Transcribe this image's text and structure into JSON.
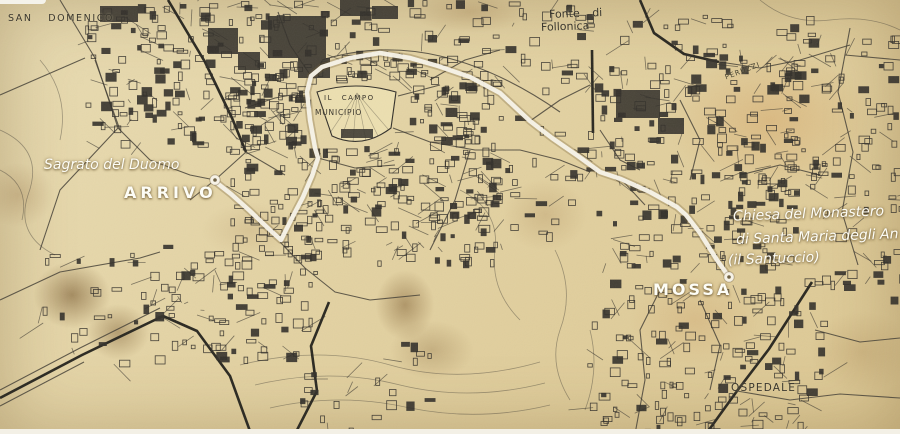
{
  "map": {
    "region_labels": {
      "san_domenico": "SAN DOMENICO",
      "fonte_line1": "Fonte di",
      "fonte_line2": "Follonica",
      "peruzzi": "PERUZZI",
      "il_campo": "IL CAMPO",
      "municipio": "MUNICIPIO",
      "ospedale": "OSPEDALE"
    },
    "route_labels": {
      "sagrato_del_duomo": "Sagrato del Duomo",
      "arrivo": "ARRIVO",
      "chiesa_line1": "Chiesa del Monastero",
      "chiesa_line2": "di Santa Maria degli An",
      "chiesa_line3": "(il Santuccio)",
      "mossa": "MOSSA"
    },
    "route": {
      "points": "217,183 231,194 250,211 271,231 281,240 292,218 303,197 312,176 318,158 315,148 310,120 307,92 311,76 322,67 350,58 380,53 410,58 438,66 470,77 500,93 530,121 552,138 578,156 600,172 621,179 650,192 677,207 686,215 700,233 717,260 729,277",
      "start": {
        "x": "729",
        "y": "277",
        "label": "MOSSA"
      },
      "end": {
        "x": "215",
        "y": "180",
        "label": "ARRIVO"
      }
    },
    "colors": {
      "paper": "#e4d4a6",
      "ink": "#33302a",
      "stain": "#8d6c42",
      "route_line": "#f8f4e8",
      "label_white": "#fdfdf6"
    }
  }
}
